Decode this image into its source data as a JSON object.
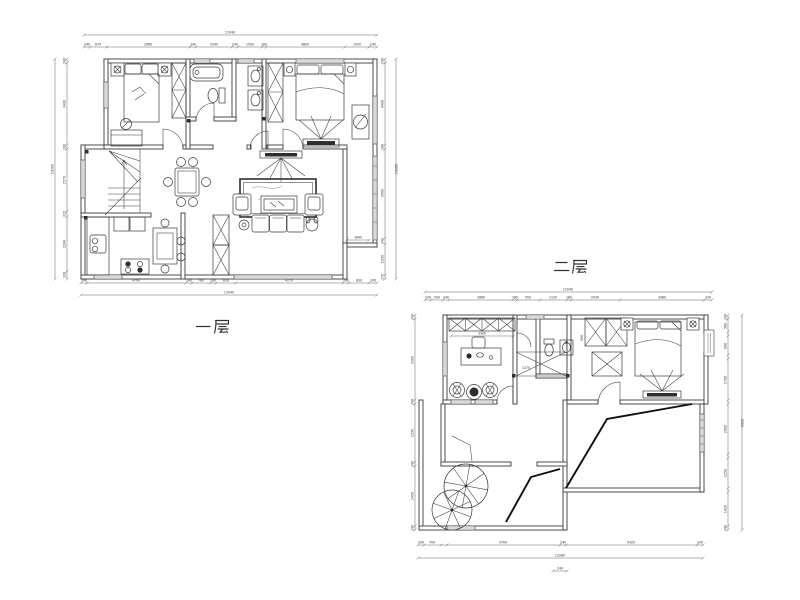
{
  "drawing_title": "两层户型平面图",
  "colors": {
    "background": "#ffffff",
    "line": "#3b3b3b",
    "dimension": "#555555",
    "slope_line": "#0f0f0f",
    "dark_fill": "#2e2e2e"
  },
  "floor1": {
    "label": "一层",
    "dims": {
      "top_total": "12040",
      "top": [
        "240",
        "870",
        "3360",
        "240",
        "2040",
        "240",
        "1500",
        "160",
        "4800",
        "1000",
        "240"
      ],
      "bottom": [
        "240",
        "4790",
        "240",
        "780",
        "240",
        "830",
        "4270",
        "240",
        "830",
        "330"
      ],
      "bottom_total": "12040",
      "left": [
        "240",
        "3400",
        "190",
        "2570",
        "215",
        "2240",
        "330"
      ],
      "left_total": "10180",
      "right": [
        "240",
        "3400",
        "240",
        "3900",
        "240",
        "1290",
        "170"
      ],
      "right_total": "10180",
      "bay": "1840"
    }
  },
  "floor2": {
    "label": "二层",
    "dims": {
      "top_total": "12040",
      "top": [
        "240",
        "500",
        "240",
        "2660",
        "160",
        "950",
        "1120",
        "160",
        "2030",
        "3480",
        "330"
      ],
      "bottom": [
        "240",
        "700",
        "4700",
        "240",
        "5420",
        "240"
      ],
      "bottom_total": "12280",
      "bottom_small": "240",
      "left": [
        "240",
        "3280",
        "240",
        "2330",
        "240",
        "2450",
        "240"
      ],
      "right": [
        "240",
        "560",
        "800",
        "1700",
        "2080",
        "1250",
        "1420",
        "240"
      ],
      "right_total": "8920",
      "shelf": "3300",
      "bath": "1470",
      "closet": "900"
    }
  }
}
